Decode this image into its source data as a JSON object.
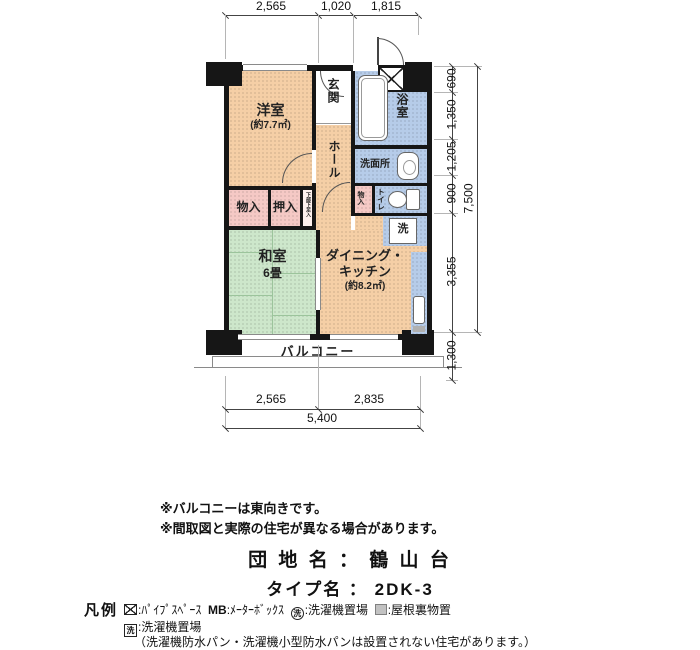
{
  "plan": {
    "dims_top": [
      "2,565",
      "1,020",
      "1,815"
    ],
    "dims_right": [
      "690",
      "1,350",
      "1,205",
      "900",
      "3,355",
      "1,300"
    ],
    "dims_right_total": "7,500",
    "dims_bottom": [
      "2,565",
      "2,835"
    ],
    "dims_bottom_total": "5,400",
    "rooms": {
      "western": {
        "label": "洋室",
        "area": "(約7.7㎡)"
      },
      "genkan": "玄関",
      "hall": "ホール",
      "bath": "浴室",
      "washroom": "洗面所",
      "toilet": "トイレ",
      "storage_left": "物入",
      "closet": "押入",
      "closet_note": "下部下足入",
      "storage_small": "物入",
      "washitsu": {
        "label": "和室",
        "size": "6畳"
      },
      "dk": {
        "line1": "ダイニング・",
        "line2": "キッチン",
        "area": "(約8.2㎡)"
      },
      "laundry": "洗",
      "balcony": "バルコニー"
    },
    "colors": {
      "western": "#f5cfa6",
      "washitsu": "#cde7cb",
      "wet_area": "#b6cce9",
      "storage": "#f5c9c5",
      "wall": "#161616"
    }
  },
  "notes": [
    "※バルコニーは東向きです。",
    "※間取図と実際の住宅が異なる場合があります。"
  ],
  "title": {
    "danchi": "団 地 名 ： 鶴 山 台",
    "type": "タイプ名 ： 2DK-3"
  },
  "legend": {
    "heading": "凡例",
    "items": [
      {
        "icon": "pipe-space-icon",
        "label": ":ﾊﾟｲﾌﾟｽﾍﾟｰｽ"
      },
      {
        "icon_text": "MB",
        "label": ":ﾒｰﾀｰﾎﾞｯｸｽ"
      },
      {
        "icon": "laundry-circle-icon",
        "icon_text": "洗",
        "label": ":洗濯機置場"
      },
      {
        "icon": "attic-storage-icon",
        "label": ":屋根裏物置"
      }
    ],
    "line2": {
      "icon_text": "洗",
      "label": ":洗濯機置場"
    },
    "line3": "（洗濯機防水パン・洗濯機小型防水パンは設置されない住宅があります。）"
  }
}
